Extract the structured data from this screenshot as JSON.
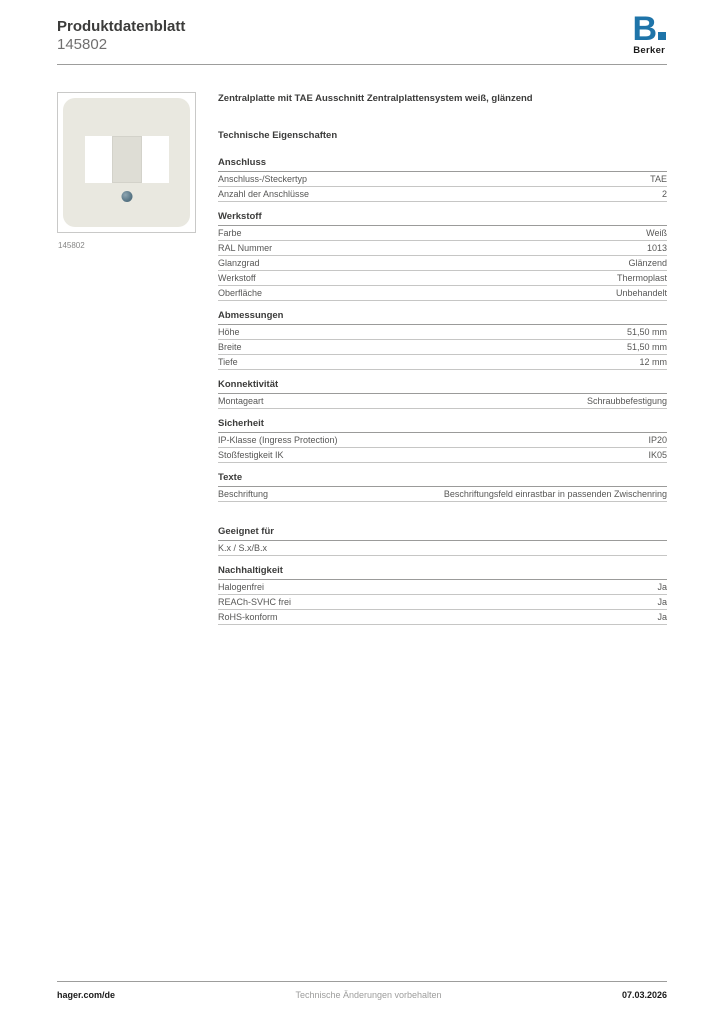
{
  "header": {
    "title": "Produktdatenblatt",
    "product_number": "145802"
  },
  "logo": {
    "letter_b": "B",
    "brand": "Berker",
    "brand_blue": "#1e74a9"
  },
  "product": {
    "image_caption": "145802",
    "name": "Zentralplatte mit TAE Ausschnitt Zentralplattensystem weiß, glänzend",
    "image_colors": {
      "plate": "#e9e8e0",
      "center_cutout": "#deddd5",
      "screw": "#5d7a8a"
    }
  },
  "specs": {
    "heading": "Technische Eigenschaften",
    "sections": [
      {
        "title": "Anschluss",
        "rows": [
          {
            "label": "Anschluss-/Steckertyp",
            "value": "TAE"
          },
          {
            "label": "Anzahl der Anschlüsse",
            "value": "2"
          }
        ]
      },
      {
        "title": "Werkstoff",
        "rows": [
          {
            "label": "Farbe",
            "value": "Weiß"
          },
          {
            "label": "RAL Nummer",
            "value": "1013"
          },
          {
            "label": "Glanzgrad",
            "value": "Glänzend"
          },
          {
            "label": "Werkstoff",
            "value": "Thermoplast"
          },
          {
            "label": "Oberfläche",
            "value": "Unbehandelt"
          }
        ]
      },
      {
        "title": "Abmessungen",
        "rows": [
          {
            "label": "Höhe",
            "value": "51,50 mm"
          },
          {
            "label": "Breite",
            "value": "51,50 mm"
          },
          {
            "label": "Tiefe",
            "value": "12 mm"
          }
        ]
      },
      {
        "title": "Konnektivität",
        "rows": [
          {
            "label": "Montageart",
            "value": "Schraubbefestigung"
          }
        ]
      },
      {
        "title": "Sicherheit",
        "rows": [
          {
            "label": "IP-Klasse (Ingress Protection)",
            "value": "IP20"
          },
          {
            "label": "Stoßfestigkeit IK",
            "value": "IK05"
          }
        ]
      },
      {
        "title": "Texte",
        "rows": [
          {
            "label": "Beschriftung",
            "value": "Beschriftungsfeld einrastbar in passenden Zwischenring"
          }
        ]
      },
      {
        "title": "Geeignet für",
        "extra_gap": true,
        "rows": [
          {
            "label": "K.x / S.x/B.x",
            "value": ""
          }
        ]
      },
      {
        "title": "Nachhaltigkeit",
        "rows": [
          {
            "label": "Halogenfrei",
            "value": "Ja"
          },
          {
            "label": "REACh-SVHC frei",
            "value": "Ja"
          },
          {
            "label": "RoHS-konform",
            "value": "Ja"
          }
        ]
      }
    ]
  },
  "footer": {
    "left": "hager.com/de",
    "center": "Technische Änderungen vorbehalten",
    "right": "07.03.2026"
  }
}
